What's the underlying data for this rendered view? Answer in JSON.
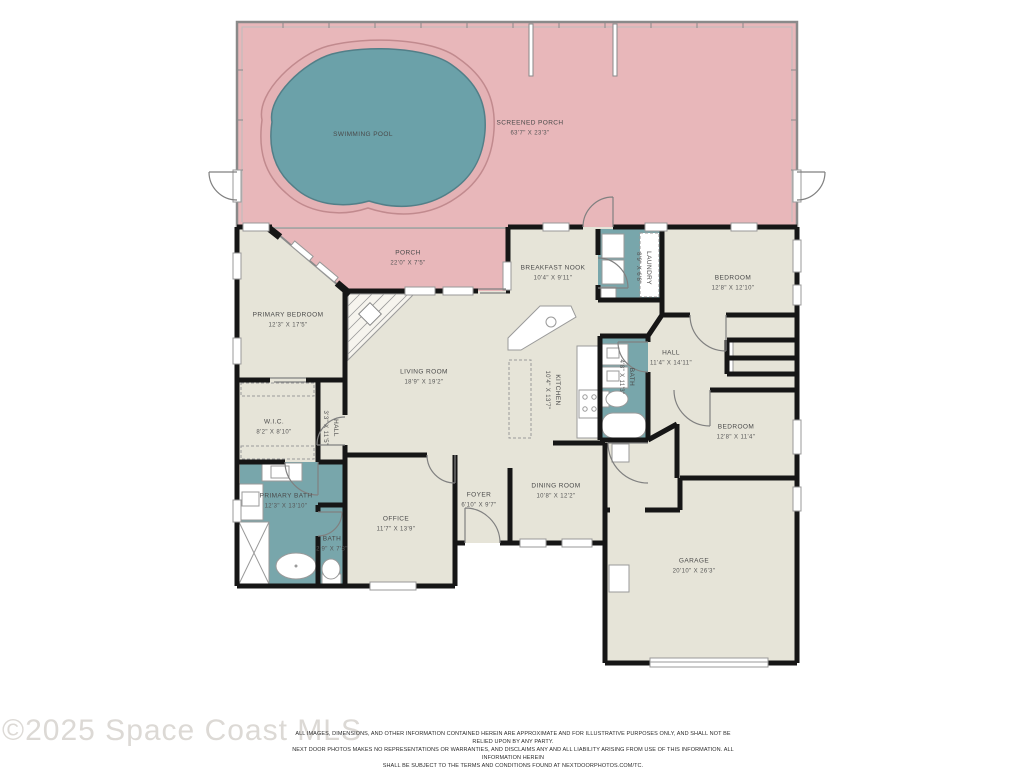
{
  "watermark": "©2025 Space Coast MLS",
  "disclaimer": {
    "lines": [
      "ALL IMAGES, DIMENSIONS, AND OTHER INFORMATION CONTAINED HEREIN ARE APPROXIMATE AND FOR ILLUSTRATIVE PURPOSES ONLY, AND SHALL NOT BE RELIED UPON BY ANY PARTY.",
      "NEXT DOOR PHOTOS MAKES NO REPRESENTATIONS OR WARRANTIES, AND DISCLAIMS ANY AND ALL LIABILITY ARISING FROM USE OF THIS INFORMATION. ALL INFORMATION HEREIN",
      "SHALL BE SUBJECT TO THE TERMS AND CONDITIONS FOUND AT NEXTDOORPHOTOS.COM/TC."
    ]
  },
  "colors": {
    "porch-pink": "#e8b7ba",
    "pool-teal": "#6ba1a9",
    "bath-teal": "#78a6ab",
    "room-beige": "#e6e4d8",
    "wall-black": "#161616"
  },
  "rooms": [
    {
      "id": "screened-porch",
      "name": "SCREENED PORCH",
      "dims": "63'7\" X 23'3\""
    },
    {
      "id": "swimming-pool",
      "name": "SWIMMING POOL"
    },
    {
      "id": "porch",
      "name": "PORCH",
      "dims": "22'0\" X 7'5\""
    },
    {
      "id": "primary-bedroom",
      "name": "PRIMARY BEDROOM",
      "dims": "12'3\" X 17'5\""
    },
    {
      "id": "breakfast-nook",
      "name": "BREAKFAST NOOK",
      "dims": "10'4\" X 9'11\""
    },
    {
      "id": "laundry",
      "name": "LAUNDRY",
      "dims": "8'9\" X 6'8\""
    },
    {
      "id": "bedroom-1",
      "name": "BEDROOM",
      "dims": "12'8\" X 12'10\""
    },
    {
      "id": "living-room",
      "name": "LIVING ROOM",
      "dims": "18'9\" X 19'2\""
    },
    {
      "id": "kitchen",
      "name": "KITCHEN",
      "dims": "10'4\" X 13'7\""
    },
    {
      "id": "hall",
      "name": "HALL",
      "dims": "11'4\" X 14'11\""
    },
    {
      "id": "bath-hall",
      "name": "BATH",
      "dims": "4'8\" X 11'3\""
    },
    {
      "id": "bedroom-2",
      "name": "BEDROOM",
      "dims": "12'8\" X 11'4\""
    },
    {
      "id": "wic",
      "name": "W.I.C.",
      "dims": "8'2\" X 8'10\""
    },
    {
      "id": "hall-small",
      "name": "HALL",
      "dims": "3'3\" X 11'5\""
    },
    {
      "id": "primary-bath",
      "name": "PRIMARY BATH",
      "dims": "12'3\" X 13'10\""
    },
    {
      "id": "bath-small",
      "name": "BATH",
      "dims": "2'9\" X 7'8\""
    },
    {
      "id": "office",
      "name": "OFFICE",
      "dims": "11'7\" X 13'9\""
    },
    {
      "id": "foyer",
      "name": "FOYER",
      "dims": "6'10\" X 9'7\""
    },
    {
      "id": "dining-room",
      "name": "DINING ROOM",
      "dims": "10'8\" X 12'2\""
    },
    {
      "id": "garage",
      "name": "GARAGE",
      "dims": "20'10\" X 26'3\""
    }
  ]
}
